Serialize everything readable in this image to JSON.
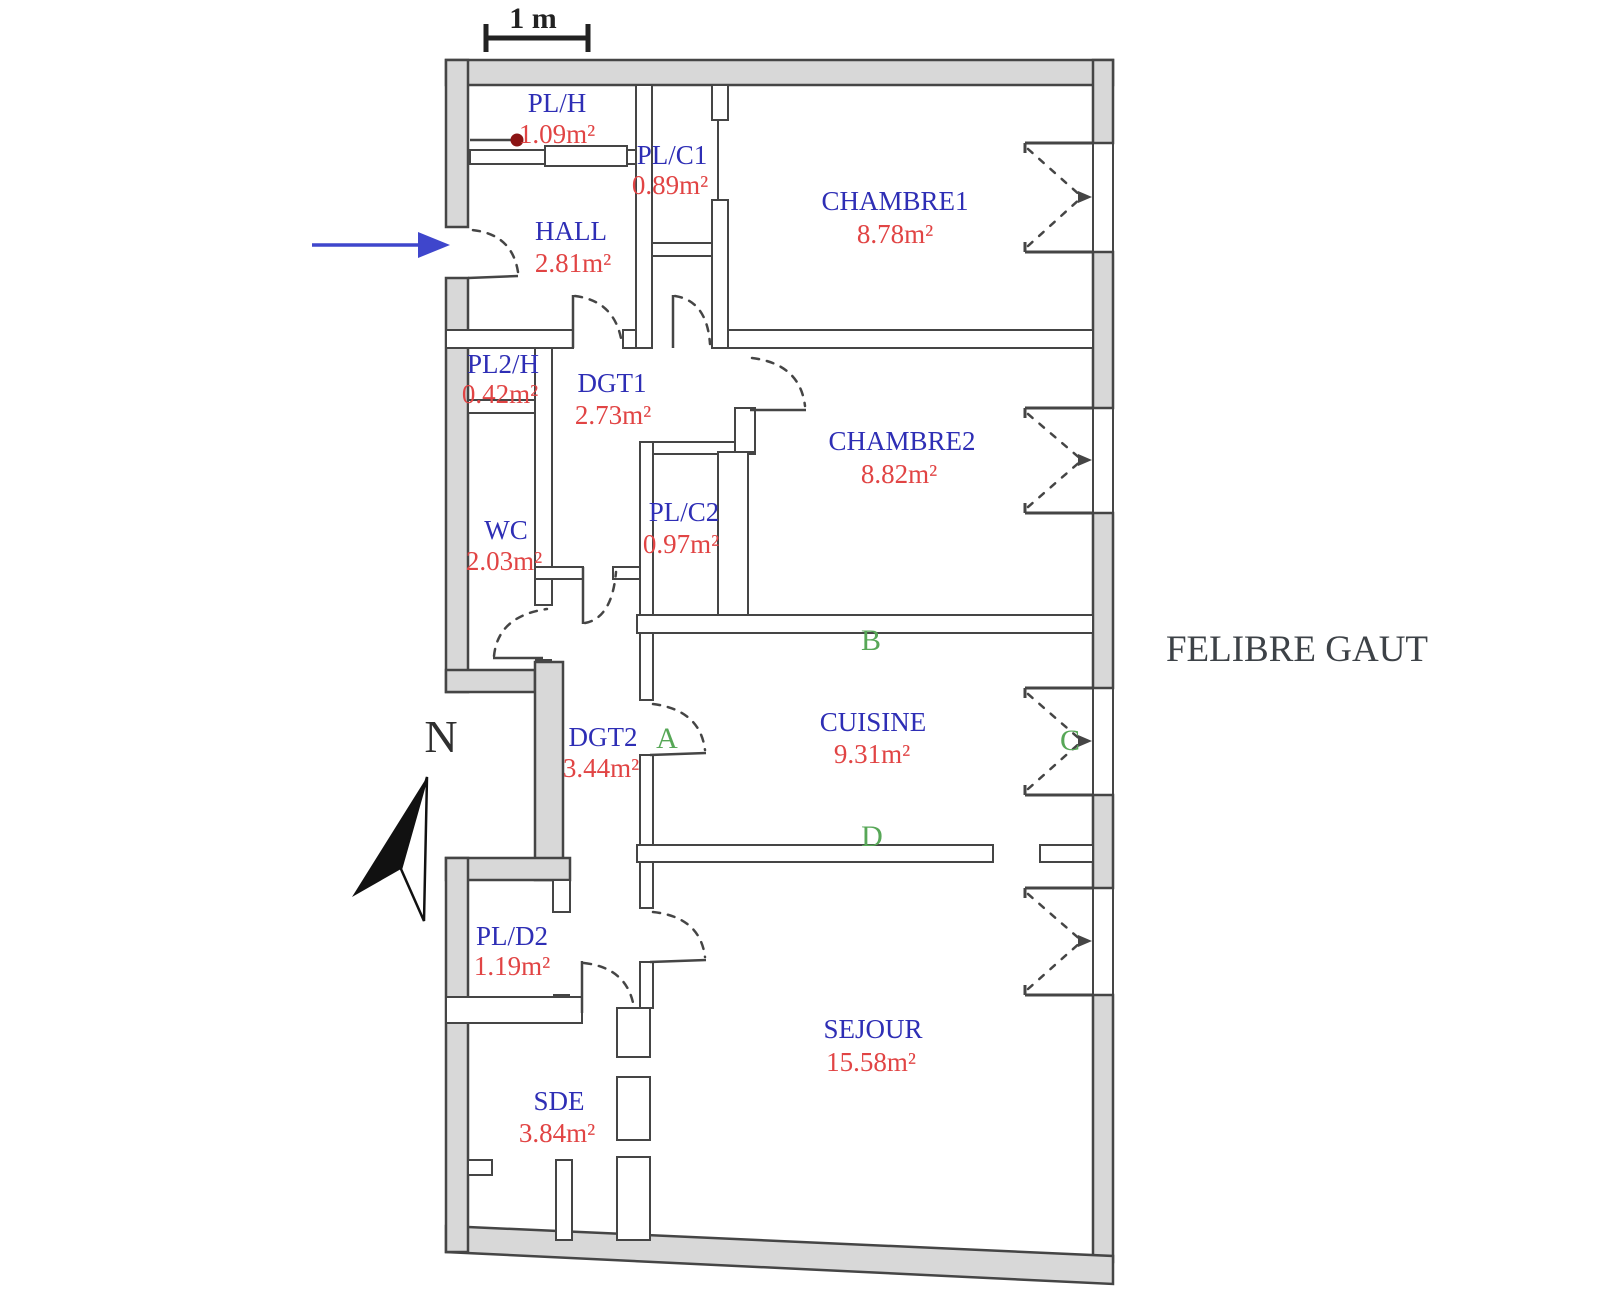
{
  "title": {
    "label": "FELIBRE GAUT"
  },
  "scale_bar": {
    "label": "1 m"
  },
  "compass": {
    "label": "N"
  },
  "rooms": [
    {
      "id": "pl_h",
      "name": "PL/H",
      "area": "1.09m²"
    },
    {
      "id": "pl_c1",
      "name": "PL/C1",
      "area": "0.89m²"
    },
    {
      "id": "chambre1",
      "name": "CHAMBRE1",
      "area": "8.78m²"
    },
    {
      "id": "hall",
      "name": "HALL",
      "area": "2.81m²"
    },
    {
      "id": "pl2_h",
      "name": "PL2/H",
      "area": "0.42m²"
    },
    {
      "id": "dgt1",
      "name": "DGT1",
      "area": "2.73m²"
    },
    {
      "id": "chambre2",
      "name": "CHAMBRE2",
      "area": "8.82m²"
    },
    {
      "id": "wc",
      "name": "WC",
      "area": "2.03m²"
    },
    {
      "id": "pl_c2",
      "name": "PL/C2",
      "area": "0.97m²"
    },
    {
      "id": "dgt2",
      "name": "DGT2",
      "area": "3.44m²"
    },
    {
      "id": "cuisine",
      "name": "CUISINE",
      "area": "9.31m²"
    },
    {
      "id": "pl_d2",
      "name": "PL/D2",
      "area": "1.19m²"
    },
    {
      "id": "sejour",
      "name": "SEJOUR",
      "area": "15.58m²"
    },
    {
      "id": "sde",
      "name": "SDE",
      "area": "3.84m²"
    }
  ],
  "markers": {
    "a": "A",
    "b": "B",
    "c": "C",
    "d": "D"
  },
  "colors": {
    "room_label_blue": "#2e2eb5",
    "area_red": "#e14444",
    "marker_green": "#57a757",
    "wall_fill_gray": "#d8d8d8",
    "line_dark": "#454545",
    "entrance_arrow_blue": "#3f46cc",
    "closet_dot_red": "#8b1414",
    "title_gray": "#3d4247"
  }
}
